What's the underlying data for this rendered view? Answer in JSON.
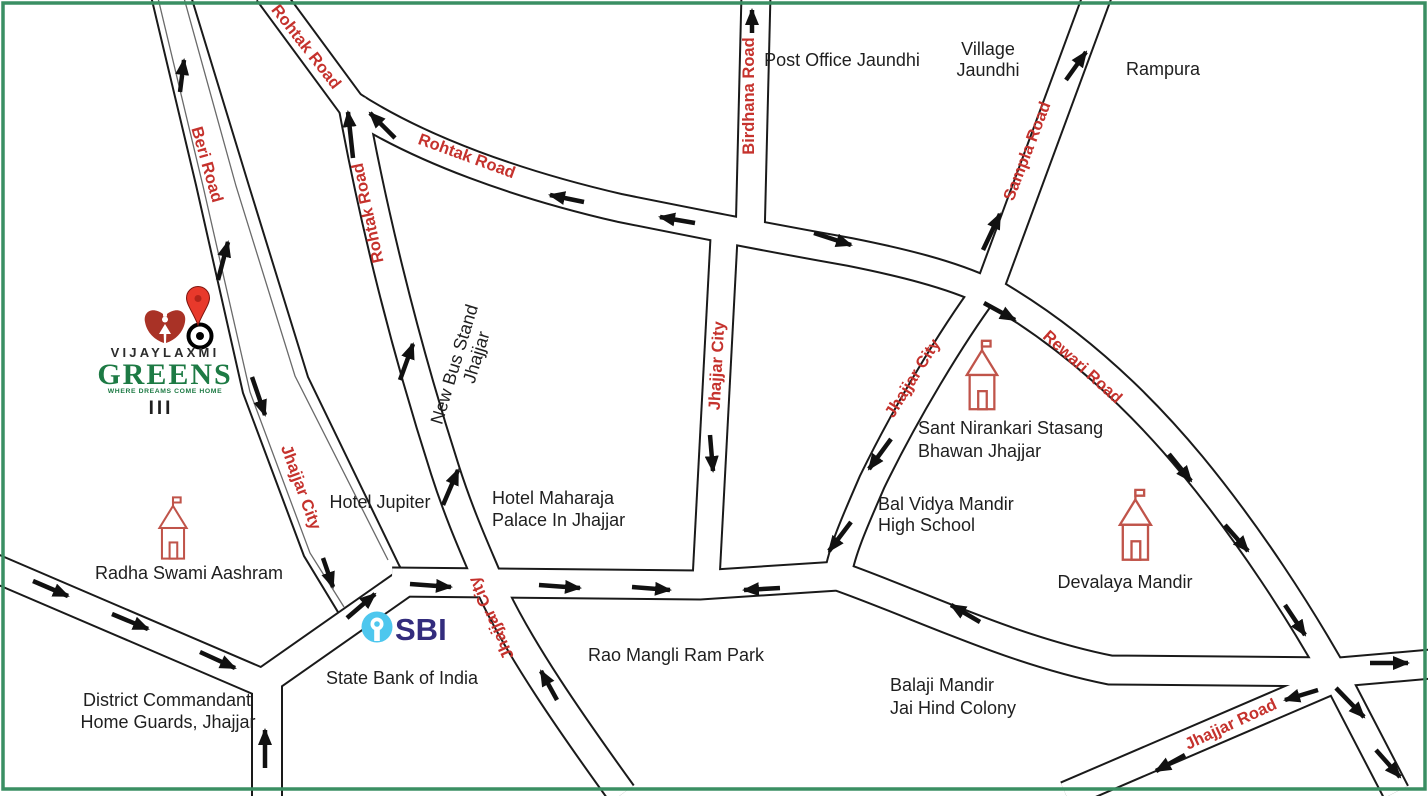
{
  "map": {
    "colors": {
      "border": "#3a8f63",
      "road-label": "#c5322d",
      "place-label": "#1f1f1f",
      "road-casing": "#1a1a1a",
      "arrow": "#111111",
      "temple": "#c0544a",
      "pin": "#e8392b",
      "pin-edge": "#7e150e",
      "brand-red": "#a93226",
      "brand-green": "#1d7a44",
      "brand-dark": "#2b2b2b",
      "sbi-blue": "#4ec7ee",
      "sbi-navy": "#332c7d"
    }
  },
  "logo": {
    "brand_top": "VIJAYLAXMI",
    "brand_main": "GREENS",
    "tagline": "WHERE DREAMS COME HOME",
    "phase": "III"
  },
  "bank": {
    "logo_text": "SBI",
    "name": "State Bank of India"
  },
  "road_labels": {
    "beri": "Beri Road",
    "rohtak_branch": "Rohtak Road",
    "rohtak_vertical": "Rohtak Road",
    "rohtak_curve": "Rohtak Road",
    "birdhana": "Birdhana Road",
    "sampla": "Sampla Road",
    "rewari": "Rewari Road",
    "jhajjar_city_west": "Jhajjar City",
    "jhajjar_city_center": "Jhajjar City",
    "jhajjar_city_east": "Jhajjar City",
    "jhajjar_city_south": "Jhajjar City",
    "jhajjar_road": "Jhajjar Road"
  },
  "places": {
    "post_office": "Post Office Jaundhi",
    "village_jaundhi_line1": "Village",
    "village_jaundhi_line2": "Jaundhi",
    "rampura": "Rampura",
    "new_bus_stand_line1": "New Bus Stand",
    "new_bus_stand_line2": "Jhajjar",
    "hotel_jupiter": "Hotel Jupiter",
    "hotel_maharaja_line1": "Hotel Maharaja",
    "hotel_maharaja_line2": "Palace In Jhajjar",
    "sant_nirankari_line1": "Sant Nirankari Stasang",
    "sant_nirankari_line2": "Bhawan Jhajjar",
    "bal_vidya_line1": "Bal Vidya Mandir",
    "bal_vidya_line2": "High School",
    "devalaya": "Devalaya Mandir",
    "radha_swami": "Radha Swami Aashram",
    "district_line1": "District Commandant",
    "district_line2": "Home Guards, Jhajjar",
    "rao_mangli": "Rao Mangli Ram Park",
    "balaji_line1": "Balaji Mandir",
    "balaji_line2": "Jai Hind Colony"
  }
}
